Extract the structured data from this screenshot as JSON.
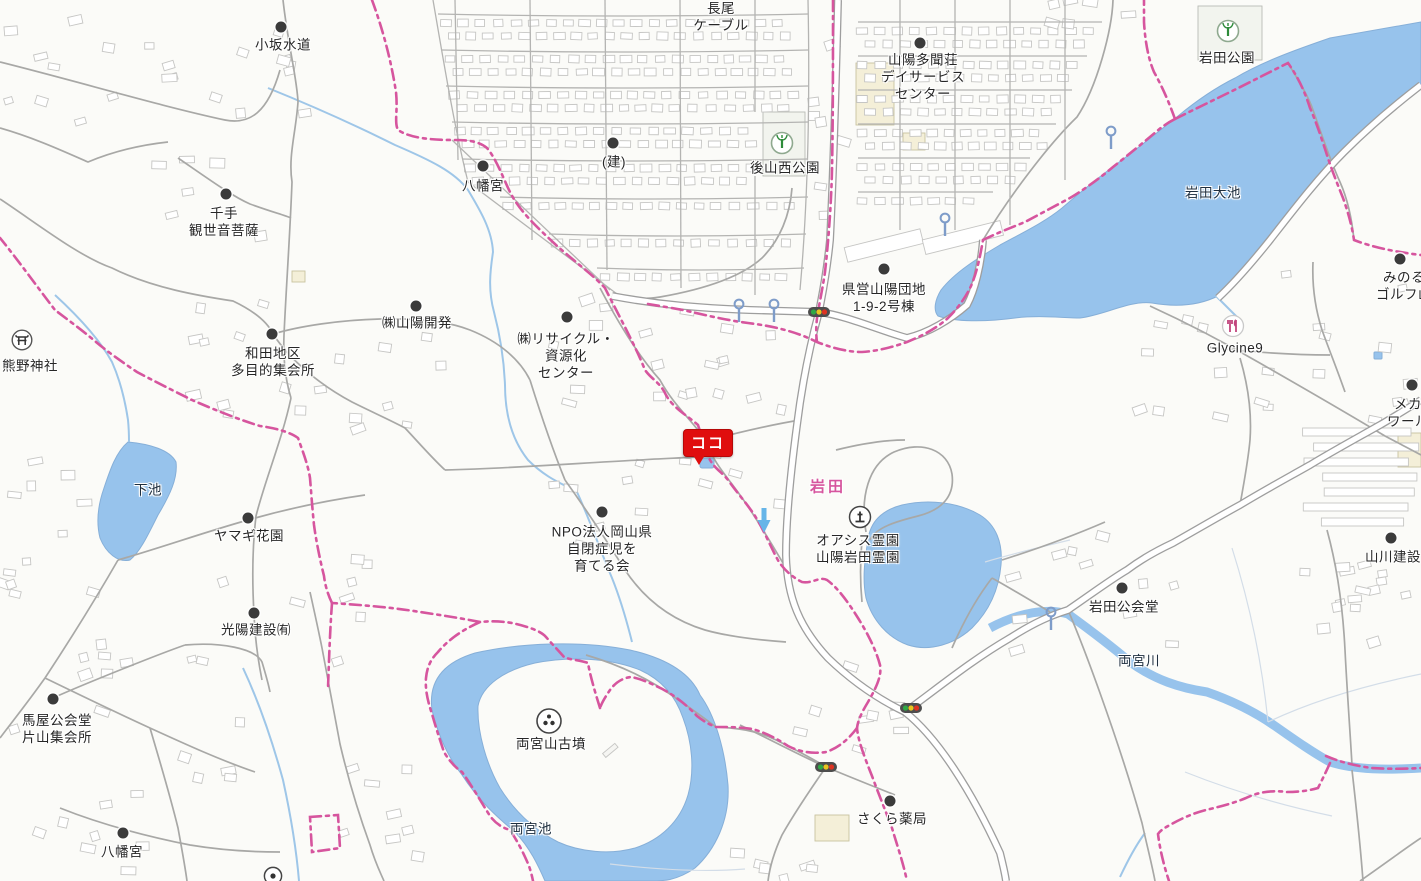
{
  "map": {
    "marker": {
      "label": "ココ",
      "x": 708,
      "y": 443,
      "color": "#E00E0E"
    },
    "colors": {
      "water": "#97C3EC",
      "boundary_pink": "#D6559E",
      "place_pink": "#D6559E",
      "road_casing": "#9E9E9E",
      "building_stroke": "#C6C6C4",
      "marker_red": "#E00E0E",
      "label_text": "#262626",
      "park_green": "#2E8B3A",
      "restaurant_pink": "#C2457E",
      "pole_blue": "#7E9CC9",
      "arrow_blue": "#66B5E8",
      "traffic_green": "#2FA845",
      "traffic_yellow": "#E8C51E",
      "traffic_red": "#DD3322"
    },
    "labels": [
      {
        "id": "kosaka-suido",
        "lines": [
          "小坂水道"
        ],
        "x": 283,
        "y": 45,
        "dot": [
          281,
          27
        ]
      },
      {
        "id": "nagao-cable",
        "lines": [
          "長尾",
          "ケーブル"
        ],
        "x": 721,
        "y": 17
      },
      {
        "id": "sanyo-tamonso-daycare",
        "lines": [
          "山陽多聞荘",
          "デイサービス",
          "センター"
        ],
        "x": 923,
        "y": 77,
        "dot": [
          920,
          43
        ]
      },
      {
        "id": "iwata-park",
        "lines": [
          "岩田公園"
        ],
        "x": 1227,
        "y": 58,
        "icon": "park",
        "iconPos": [
          1228,
          31
        ]
      },
      {
        "id": "tatemono",
        "lines": [
          "(建)"
        ],
        "x": 614,
        "y": 162,
        "dot": [
          613,
          143
        ]
      },
      {
        "id": "ushiroyama-nishi-park",
        "lines": [
          "後山西公園"
        ],
        "x": 785,
        "y": 168,
        "icon": "park",
        "iconPos": [
          782,
          143
        ]
      },
      {
        "id": "hachimangu-north",
        "lines": [
          "八幡宮"
        ],
        "x": 483,
        "y": 186,
        "dot": [
          483,
          166
        ]
      },
      {
        "id": "iwata-oike",
        "lines": [
          "岩田大池"
        ],
        "x": 1213,
        "y": 193,
        "kind": "water"
      },
      {
        "id": "senju-kanzeon",
        "lines": [
          "千手",
          "観世音菩薩"
        ],
        "x": 224,
        "y": 222,
        "dot": [
          226,
          194
        ]
      },
      {
        "id": "kenei-sanyo-danchi",
        "lines": [
          "県営山陽団地",
          "1-9-2号棟"
        ],
        "x": 884,
        "y": 298,
        "dot": [
          884,
          269
        ]
      },
      {
        "id": "minoru-golf",
        "lines": [
          "みのる",
          "ゴルフ山"
        ],
        "x": 1404,
        "y": 286,
        "dot": [
          1400,
          259
        ]
      },
      {
        "id": "kumano-jinja",
        "lines": [
          "熊野神社"
        ],
        "x": 30,
        "y": 366,
        "icon": "torii",
        "iconPos": [
          22,
          340
        ]
      },
      {
        "id": "sanyo-kaihatsu",
        "lines": [
          "㈱山陽開発"
        ],
        "x": 417,
        "y": 323,
        "dot": [
          416,
          306
        ]
      },
      {
        "id": "wada-chiku-shukaisho",
        "lines": [
          "和田地区",
          "多目的集会所"
        ],
        "x": 273,
        "y": 362,
        "dot": [
          272,
          334
        ]
      },
      {
        "id": "recycle-center",
        "lines": [
          "㈱リサイクル・",
          "資源化",
          "センター"
        ],
        "x": 566,
        "y": 356,
        "dot": [
          567,
          317
        ]
      },
      {
        "id": "glycine9",
        "lines": [
          "Glycine9"
        ],
        "x": 1235,
        "y": 348,
        "icon": "restaurant",
        "iconPos": [
          1233,
          326
        ]
      },
      {
        "id": "meka-world",
        "lines": [
          "メカ",
          "ワール"
        ],
        "x": 1408,
        "y": 413,
        "dot": [
          1412,
          385
        ]
      },
      {
        "id": "shimoike",
        "lines": [
          "下池"
        ],
        "x": 148,
        "y": 490,
        "kind": "water"
      },
      {
        "id": "yamagi-kaen",
        "lines": [
          "ヤマギ花園"
        ],
        "x": 249,
        "y": 536,
        "dot": [
          248,
          518
        ]
      },
      {
        "id": "iwata-place",
        "lines": [
          "岩田"
        ],
        "x": 828,
        "y": 487,
        "kind": "place-pink"
      },
      {
        "id": "oasis-reien",
        "lines": [
          "オアシス霊園",
          "山陽岩田霊園"
        ],
        "x": 858,
        "y": 549,
        "icon": "cemetery",
        "iconPos": [
          860,
          517
        ]
      },
      {
        "id": "npo-okayama",
        "lines": [
          "NPO法人岡山県",
          "自閉症児を",
          "育てる会"
        ],
        "x": 602,
        "y": 549,
        "dot": [
          602,
          512
        ]
      },
      {
        "id": "koyo-kensetsu",
        "lines": [
          "光陽建設㈲"
        ],
        "x": 256,
        "y": 630,
        "dot": [
          254,
          613
        ]
      },
      {
        "id": "yamakawa-kensetsu",
        "lines": [
          "山川建設"
        ],
        "x": 1393,
        "y": 557,
        "dot": [
          1391,
          538
        ]
      },
      {
        "id": "iwata-kokaido",
        "lines": [
          "岩田公会堂"
        ],
        "x": 1124,
        "y": 607,
        "dot": [
          1122,
          588
        ]
      },
      {
        "id": "ryogu-gawa",
        "lines": [
          "両宮川"
        ],
        "x": 1139,
        "y": 661,
        "kind": "water"
      },
      {
        "id": "umaya-kokaido",
        "lines": [
          "馬屋公会堂",
          "片山集会所"
        ],
        "x": 57,
        "y": 729,
        "dot": [
          53,
          699
        ]
      },
      {
        "id": "ryoguzan-kofun",
        "lines": [
          "両宮山古墳"
        ],
        "x": 551,
        "y": 744,
        "icon": "kofun",
        "iconPos": [
          549,
          721
        ]
      },
      {
        "id": "ryogu-ike",
        "lines": [
          "両宮池"
        ],
        "x": 531,
        "y": 829,
        "kind": "water"
      },
      {
        "id": "sakura-yakkyoku",
        "lines": [
          "さくら薬局"
        ],
        "x": 892,
        "y": 819,
        "dot": [
          890,
          801
        ]
      },
      {
        "id": "hachimangu-south",
        "lines": [
          "八幡宮"
        ],
        "x": 122,
        "y": 852,
        "dot": [
          123,
          833
        ]
      }
    ],
    "icons": [
      {
        "type": "traffic-light",
        "x": 819,
        "y": 312
      },
      {
        "type": "traffic-light",
        "x": 911,
        "y": 708
      },
      {
        "type": "traffic-light",
        "x": 826,
        "y": 767
      },
      {
        "type": "pole",
        "x": 739,
        "y": 303
      },
      {
        "type": "pole",
        "x": 774,
        "y": 303
      },
      {
        "type": "pole",
        "x": 945,
        "y": 217
      },
      {
        "type": "pole",
        "x": 1111,
        "y": 130
      },
      {
        "type": "pole",
        "x": 1051,
        "y": 611
      },
      {
        "type": "arrow-down",
        "x": 764,
        "y": 520
      },
      {
        "type": "circle-dot",
        "x": 273,
        "y": 876
      }
    ]
  }
}
